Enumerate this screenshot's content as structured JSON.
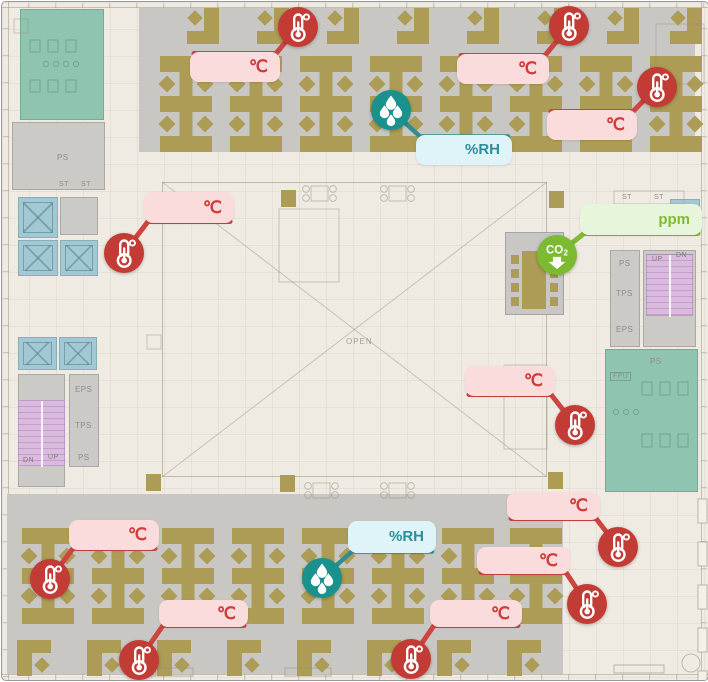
{
  "floorplan": {
    "labels": {
      "open": "OPEN",
      "ps_upper_left": "PS",
      "st_left_1": "ST",
      "st_left_2": "ST",
      "eps_lower_left": "EPS",
      "tps_lower_left": "TPS",
      "ps_lower_left": "PS",
      "dn_lower_left": "DN",
      "up_lower_left": "UP",
      "ps_right": "PS",
      "tps_right": "TPS",
      "eps_right": "EPS",
      "st_right_1": "ST",
      "st_right_2": "ST",
      "up_right": "UP",
      "dn_right": "DN",
      "ps_restroom_right": "PS",
      "fpu_right": "FPU"
    }
  },
  "sensors": {
    "types": {
      "temperature": {
        "unit": "℃",
        "icon": "thermometer-icon",
        "color": "#c23b35",
        "line_color": "#cc4540",
        "line_width": 5,
        "label_bg": "#fbdcdc",
        "label_color": "#d23b3b",
        "font_size": 17
      },
      "humidity": {
        "unit": "%RH",
        "icon": "humidity-icon",
        "color": "#1a918c",
        "line_color": "#2f8f8f",
        "line_width": 4.5,
        "label_bg": "#dff4f8",
        "label_color": "#2d8f99",
        "font_size": 15
      },
      "co2": {
        "unit": "ppm",
        "icon": "co2-icon",
        "color": "#7cbb2f",
        "line_color": "#7cbb33",
        "line_width": 5,
        "label_bg": "#e7f6db",
        "label_color": "#7cbb33",
        "font_size": 15,
        "icon_text": "CO₂"
      }
    },
    "items": [
      {
        "id": "temp-top-left",
        "type": "temperature",
        "icon": {
          "x": 296,
          "y": 25
        },
        "label": {
          "x": 188,
          "y": 50,
          "w": 90,
          "h": 30
        },
        "edge": "top",
        "conn": "right"
      },
      {
        "id": "temp-top-mid",
        "type": "temperature",
        "icon": {
          "x": 567,
          "y": 24
        },
        "label": {
          "x": 455,
          "y": 52,
          "w": 92,
          "h": 30
        },
        "edge": "top",
        "conn": "right"
      },
      {
        "id": "temp-top-right",
        "type": "temperature",
        "icon": {
          "x": 655,
          "y": 85
        },
        "label": {
          "x": 545,
          "y": 108,
          "w": 90,
          "h": 30
        },
        "edge": "top",
        "conn": "right"
      },
      {
        "id": "hum-top",
        "type": "humidity",
        "icon": {
          "x": 389,
          "y": 108
        },
        "label": {
          "x": 414,
          "y": 133,
          "w": 96,
          "h": 30
        },
        "edge": "top",
        "conn": "left"
      },
      {
        "id": "co2-center",
        "type": "co2",
        "icon": {
          "x": 555,
          "y": 253
        },
        "label": {
          "x": 578,
          "y": 202,
          "w": 122,
          "h": 31
        },
        "edge": "bottom",
        "conn": "left"
      },
      {
        "id": "temp-mid-left",
        "type": "temperature",
        "icon": {
          "x": 122,
          "y": 251
        },
        "label": {
          "x": 142,
          "y": 190,
          "w": 90,
          "h": 31
        },
        "edge": "bottom",
        "conn": "left"
      },
      {
        "id": "temp-mid-right",
        "type": "temperature",
        "icon": {
          "x": 573,
          "y": 423
        },
        "label": {
          "x": 463,
          "y": 364,
          "w": 90,
          "h": 30
        },
        "edge": "bottom",
        "conn": "right"
      },
      {
        "id": "temp-bottom-left-1",
        "type": "temperature",
        "icon": {
          "x": 48,
          "y": 577
        },
        "label": {
          "x": 67,
          "y": 518,
          "w": 90,
          "h": 30
        },
        "edge": "bottom",
        "conn": "left"
      },
      {
        "id": "temp-bottom-left-2",
        "type": "temperature",
        "icon": {
          "x": 137,
          "y": 658
        },
        "label": {
          "x": 157,
          "y": 598,
          "w": 89,
          "h": 27
        },
        "edge": "bottom",
        "conn": "left"
      },
      {
        "id": "hum-bottom",
        "type": "humidity",
        "icon": {
          "x": 320,
          "y": 576
        },
        "label": {
          "x": 346,
          "y": 519,
          "w": 88,
          "h": 32
        },
        "edge": "bottom",
        "conn": "left"
      },
      {
        "id": "temp-bottom-mid",
        "type": "temperature",
        "icon": {
          "x": 409,
          "y": 657
        },
        "label": {
          "x": 428,
          "y": 598,
          "w": 92,
          "h": 27
        },
        "edge": "bottom",
        "conn": "left"
      },
      {
        "id": "temp-bottom-right-1",
        "type": "temperature",
        "icon": {
          "x": 616,
          "y": 545
        },
        "label": {
          "x": 505,
          "y": 490,
          "w": 93,
          "h": 28
        },
        "edge": "bottom",
        "conn": "right"
      },
      {
        "id": "temp-bottom-right-2",
        "type": "temperature",
        "icon": {
          "x": 585,
          "y": 602
        },
        "label": {
          "x": 475,
          "y": 545,
          "w": 93,
          "h": 27
        },
        "edge": "bottom",
        "conn": "right"
      }
    ]
  }
}
